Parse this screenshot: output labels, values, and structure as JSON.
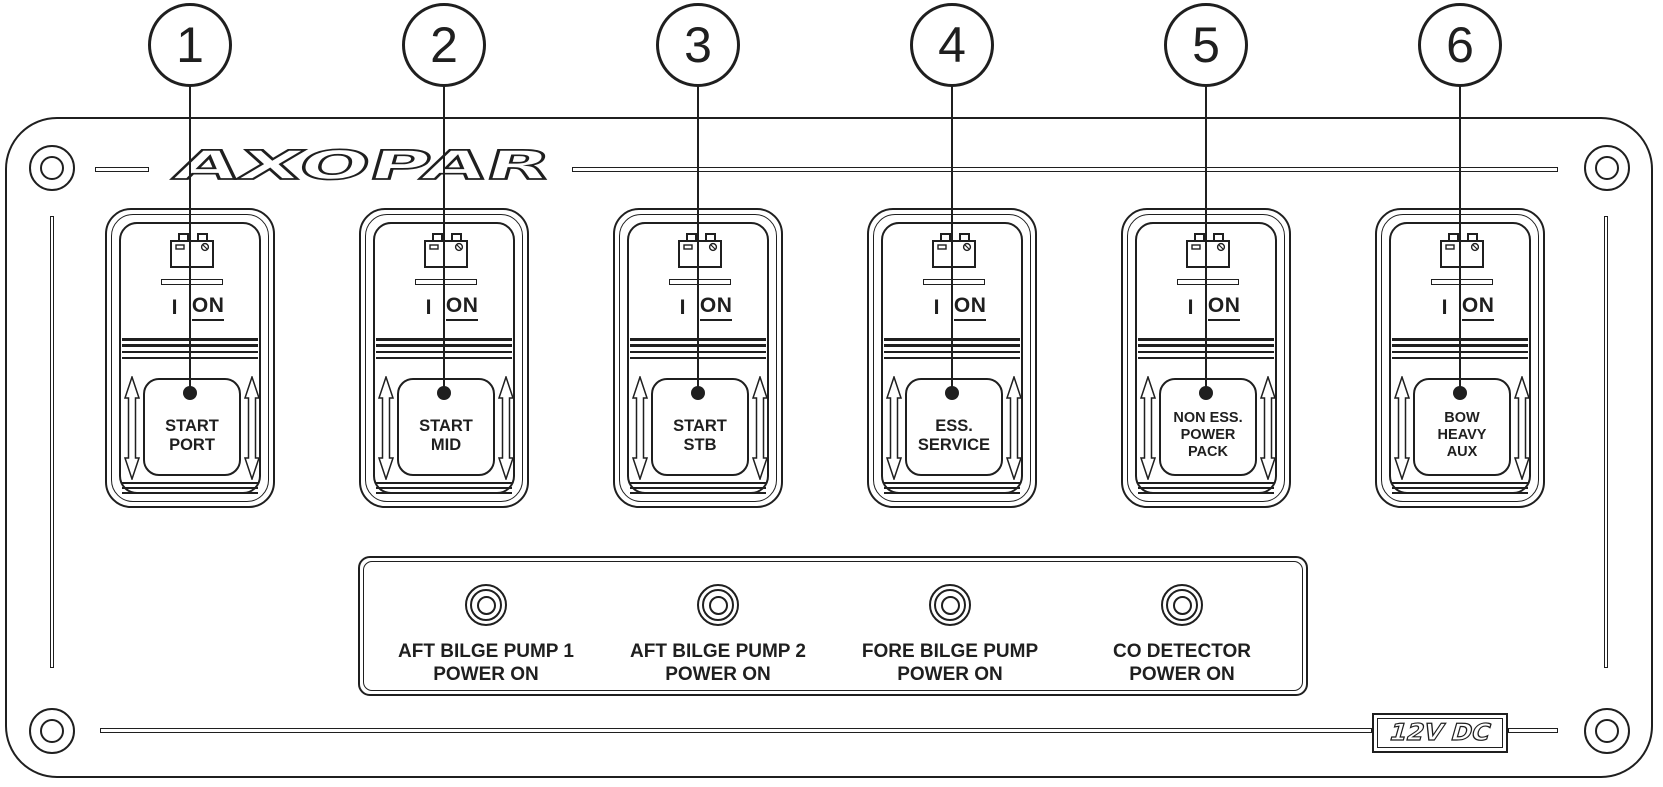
{
  "brand": {
    "logo": "AXOPAR",
    "voltage_badge": "12V DC"
  },
  "switch_common": {
    "position_label": "I",
    "on_label": "ON"
  },
  "callouts": [
    {
      "number": "1"
    },
    {
      "number": "2"
    },
    {
      "number": "3"
    },
    {
      "number": "4"
    },
    {
      "number": "5"
    },
    {
      "number": "6"
    }
  ],
  "switches": [
    {
      "label": [
        "START",
        "PORT"
      ]
    },
    {
      "label": [
        "START",
        "MID"
      ]
    },
    {
      "label": [
        "START",
        "STB"
      ]
    },
    {
      "label": [
        "ESS.",
        "SERVICE"
      ]
    },
    {
      "label": [
        "NON ESS.",
        "POWER",
        "PACK"
      ]
    },
    {
      "label": [
        "BOW",
        "HEAVY",
        "AUX"
      ]
    }
  ],
  "indicators": [
    {
      "label": [
        "AFT BILGE PUMP 1",
        "POWER ON"
      ]
    },
    {
      "label": [
        "AFT BILGE PUMP 2",
        "POWER ON"
      ]
    },
    {
      "label": [
        "FORE BILGE PUMP",
        "POWER ON"
      ]
    },
    {
      "label": [
        "CO DETECTOR",
        "POWER ON"
      ]
    }
  ]
}
